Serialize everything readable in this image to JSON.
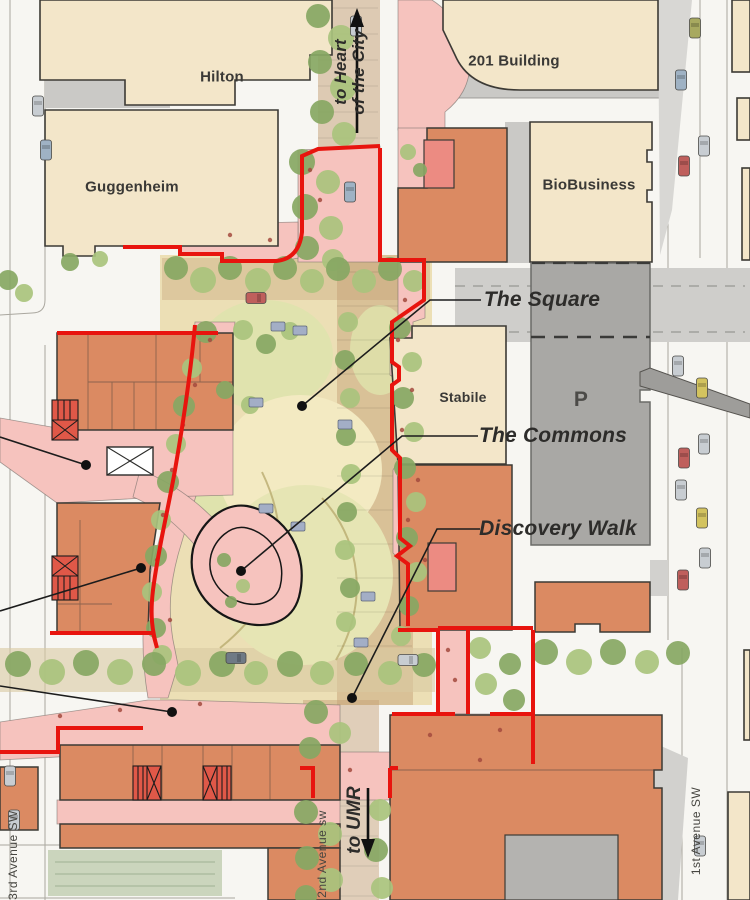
{
  "buildings": {
    "hilton": "Hilton",
    "guggenheim": "Guggenheim",
    "building201": "201 Building",
    "biobusiness": "BioBusiness",
    "stabile": "Stabile",
    "parking_p": "P"
  },
  "features": {
    "the_square": "The Square",
    "the_commons": "The Commons",
    "discovery_walk": "Discovery Walk"
  },
  "directions": {
    "north_line1": "to Heart",
    "north_line2": "of the City",
    "south": "to UMR"
  },
  "streets": {
    "second_avenue": "2nd Avenue sw",
    "third_avenue": "3rd Avenue SW",
    "first_avenue": "1st Avenue SW"
  },
  "colors": {
    "street": "#f7f6f2",
    "cream": "#f3e6c9",
    "outline": "#3c3a35",
    "orange": "#db8a62",
    "accent": "#ec8b82",
    "pink": "#f6c3be",
    "red": "#e8140e",
    "parking": "#a9a8a5",
    "shadow": "#cac9c6",
    "sand": "#ecdfb5",
    "lawn": "#dfe3ad",
    "lawn_dark": "#cbd5bd",
    "path": "#c49d74",
    "tree": "#87a763",
    "tree_light": "#a9c37d",
    "leader": "#1c1c1c"
  }
}
